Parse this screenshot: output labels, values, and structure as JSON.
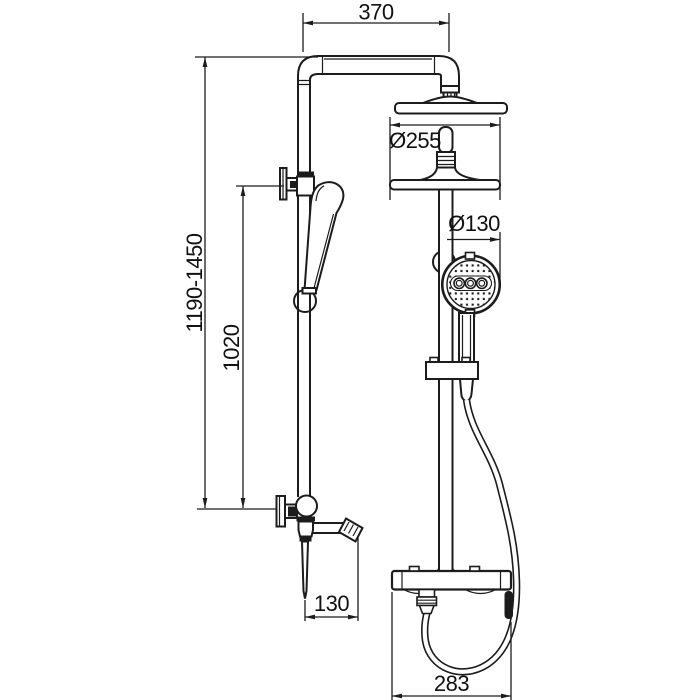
{
  "page": {
    "background_color": "#ffffff",
    "line_color": "#1c1c1c"
  },
  "drawing": {
    "dimensions": {
      "arm_reach": "370",
      "overhead_shower_diameter": "Ø255",
      "hand_shower_diameter": "Ø130",
      "overall_height_range": "1190-1450",
      "riser_rail_length": "1020",
      "spout_reach": "130",
      "mixer_bar_width": "283"
    }
  }
}
